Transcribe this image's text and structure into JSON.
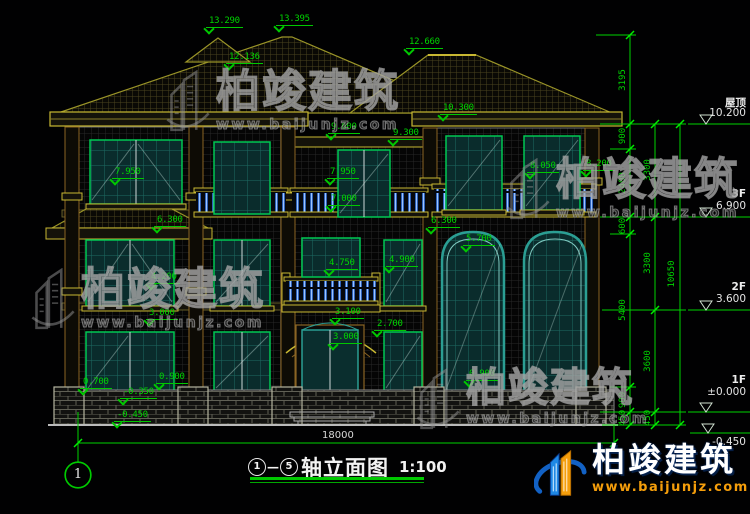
{
  "drawing": {
    "title_block": {
      "axis_start": "1",
      "axis_end": "5",
      "dash": "—",
      "name": "轴立面图",
      "scale": "1:100"
    },
    "axis_bubble": "1",
    "overall_width_dim": "18000",
    "levels": [
      {
        "name": "屋顶",
        "elev": "10.200",
        "label_y": 95
      },
      {
        "name": "3F",
        "elev": "6.900",
        "label_y": 188
      },
      {
        "name": "2F",
        "elev": "3.600",
        "label_y": 281
      },
      {
        "name": "1F",
        "elev": "±0.000",
        "label_y": 374
      },
      {
        "name": "",
        "elev": "-0.450",
        "label_y": 436
      }
    ],
    "annotations": [
      {
        "text": "13.290",
        "x": 206,
        "y": 16
      },
      {
        "text": "13.395",
        "x": 276,
        "y": 14
      },
      {
        "text": "12.136",
        "x": 226,
        "y": 52
      },
      {
        "text": "12.660",
        "x": 406,
        "y": 37
      },
      {
        "text": "10.300",
        "x": 440,
        "y": 103
      },
      {
        "text": "9.600",
        "x": 328,
        "y": 122
      },
      {
        "text": "9.300",
        "x": 390,
        "y": 128
      },
      {
        "text": "7.950",
        "x": 112,
        "y": 167
      },
      {
        "text": "7.950",
        "x": 327,
        "y": 167
      },
      {
        "text": "8.050",
        "x": 527,
        "y": 161
      },
      {
        "text": "8.200",
        "x": 583,
        "y": 159
      },
      {
        "text": "7.000",
        "x": 328,
        "y": 194
      },
      {
        "text": "6.300",
        "x": 154,
        "y": 215
      },
      {
        "text": "6.300",
        "x": 428,
        "y": 216
      },
      {
        "text": "5.700",
        "x": 463,
        "y": 234
      },
      {
        "text": "4.750",
        "x": 326,
        "y": 258
      },
      {
        "text": "4.900",
        "x": 386,
        "y": 255
      },
      {
        "text": "4.200",
        "x": 148,
        "y": 272
      },
      {
        "text": "3.100",
        "x": 332,
        "y": 307
      },
      {
        "text": "3.000",
        "x": 146,
        "y": 308
      },
      {
        "text": "2.700",
        "x": 374,
        "y": 319
      },
      {
        "text": "3.000",
        "x": 330,
        "y": 332
      },
      {
        "text": "0.700",
        "x": 80,
        "y": 377
      },
      {
        "text": "0.900",
        "x": 156,
        "y": 372
      },
      {
        "text": "0.900",
        "x": 466,
        "y": 369
      },
      {
        "text": "-0.350",
        "x": 120,
        "y": 387
      },
      {
        "text": "-0.450",
        "x": 114,
        "y": 410
      }
    ],
    "chain_dims": [
      {
        "text": "3195",
        "x": 623,
        "y": 80
      },
      {
        "text": "900",
        "x": 623,
        "y": 136
      },
      {
        "text": "2400",
        "x": 623,
        "y": 183
      },
      {
        "text": "600",
        "x": 623,
        "y": 226
      },
      {
        "text": "5400",
        "x": 623,
        "y": 310
      },
      {
        "text": "900",
        "x": 623,
        "y": 400
      },
      {
        "text": "450",
        "x": 623,
        "y": 418
      },
      {
        "text": "3300",
        "x": 648,
        "y": 170
      },
      {
        "text": "3300",
        "x": 648,
        "y": 263
      },
      {
        "text": "3600",
        "x": 648,
        "y": 361
      },
      {
        "text": "450",
        "x": 648,
        "y": 418
      },
      {
        "text": "10650",
        "x": 672,
        "y": 274
      }
    ],
    "colors": {
      "dim_green": "#00d400",
      "trim_yellow": "#c8b832",
      "window_green": "#00c853",
      "window_teal": "#2b9e93",
      "baluster_blue": "#3f7fd4",
      "watermark_gray": "#969696",
      "logo_blue": "#1e88e5",
      "logo_orange": "#f59e0b"
    }
  },
  "watermark": {
    "text": "柏竣建筑",
    "url": "www.baijunjz.com",
    "instances": [
      {
        "x": 165,
        "y": 70,
        "size": 44
      },
      {
        "x": 30,
        "y": 268,
        "size": 44
      },
      {
        "x": 505,
        "y": 158,
        "size": 44
      },
      {
        "x": 415,
        "y": 368,
        "size": 40
      }
    ]
  },
  "logo": {
    "name": "柏竣建筑",
    "url": "www.baijunjz.com"
  }
}
